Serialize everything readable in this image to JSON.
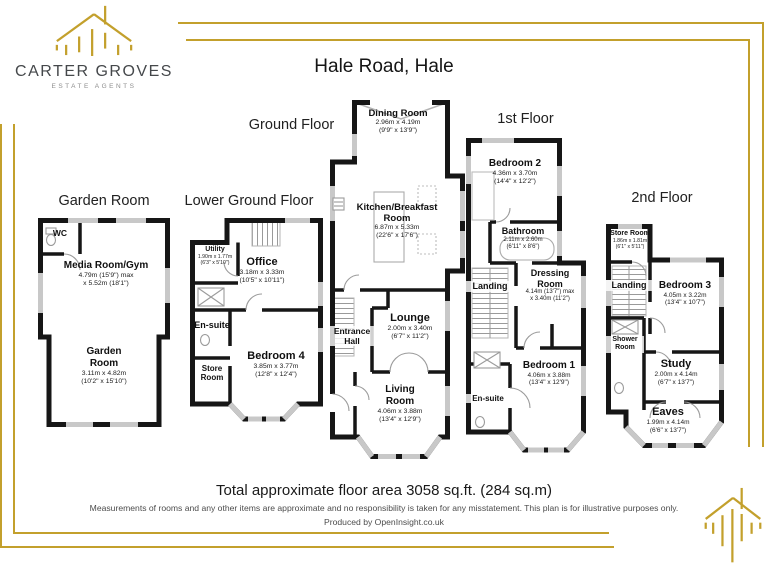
{
  "brand": {
    "name": "CARTER GROVES",
    "tagline": "ESTATE AGENTS"
  },
  "title": "Hale Road, Hale",
  "colors": {
    "gold": "#c3a02c",
    "wall": "#161616"
  },
  "floors": {
    "garden": {
      "label": "Garden Room",
      "rooms": {
        "wc": {
          "name": "WC"
        },
        "media": {
          "name": "Media Room/Gym",
          "line1": "4.79m (15'9\") max",
          "line2": "x 5.52m (18'1\")"
        },
        "garden": {
          "name": "Garden Room",
          "line1": "3.11m x 4.82m",
          "line2": "(10'2\" x 15'10\")"
        }
      }
    },
    "lower": {
      "label": "Lower Ground Floor",
      "rooms": {
        "utility": {
          "name": "Utility",
          "line1": "1.90m x 1.77m",
          "line2": "(6'3\" x 5'10\")"
        },
        "office": {
          "name": "Office",
          "line1": "3.18m x 3.33m",
          "line2": "(10'5\" x 10'11\")"
        },
        "ensuite": {
          "name": "En-suite"
        },
        "bedroom4": {
          "name": "Bedroom 4",
          "line1": "3.85m x 3.77m",
          "line2": "(12'8\" x 12'4\")"
        },
        "store": {
          "name": "Store Room"
        }
      }
    },
    "ground": {
      "label": "Ground Floor",
      "rooms": {
        "dining": {
          "name": "Dining Room",
          "line1": "2.96m x 4.19m",
          "line2": "(9'9\" x 13'9\")"
        },
        "kitchen": {
          "name": "Kitchen/Breakfast Room",
          "line1": "6.87m x 5.33m",
          "line2": "(22'6\" x 17'6\")"
        },
        "lounge": {
          "name": "Lounge",
          "line1": "2.00m x 3.40m",
          "line2": "(6'7\" x 11'2\")"
        },
        "hall": {
          "name": "Entrance Hall"
        },
        "living": {
          "name": "Living Room",
          "line1": "4.06m x 3.88m",
          "line2": "(13'4\" x 12'9\")"
        }
      }
    },
    "first": {
      "label": "1st Floor",
      "rooms": {
        "bedroom2": {
          "name": "Bedroom 2",
          "line1": "4.36m x 3.70m",
          "line2": "(14'4\" x 12'2\")"
        },
        "bathroom": {
          "name": "Bathroom",
          "line1": "2.11m x 2.60m",
          "line2": "(6'11\" x 8'6\")"
        },
        "landing": {
          "name": "Landing"
        },
        "dressing": {
          "name": "Dressing Room",
          "line1": "4.14m (13'7\") max",
          "line2": "x 3.40m (11'2\")"
        },
        "ensuite": {
          "name": "En-suite"
        },
        "bedroom1": {
          "name": "Bedroom 1",
          "line1": "4.06m x 3.88m",
          "line2": "(13'4\" x 12'9\")"
        }
      }
    },
    "second": {
      "label": "2nd Floor",
      "rooms": {
        "store": {
          "name": "Store Room",
          "line1": "1.86m x 1.81m",
          "line2": "(6'1\" x 5'11\")"
        },
        "landing": {
          "name": "Landing"
        },
        "bedroom3": {
          "name": "Bedroom 3",
          "line1": "4.05m x 3.22m",
          "line2": "(13'4\" x 10'7\")"
        },
        "shower": {
          "name": "Shower Room"
        },
        "study": {
          "name": "Study",
          "line1": "2.00m x 4.14m",
          "line2": "(6'7\" x 13'7\")"
        },
        "eaves": {
          "name": "Eaves",
          "line1": "1.99m x 4.14m",
          "line2": "(6'6\" x 13'7\")"
        }
      }
    }
  },
  "footer": {
    "total": "Total approximate floor area 3058 sq.ft. (284 sq.m)",
    "disclaimer": "Measurements of rooms and any other items are approximate and no responsibility is taken for any misstatement. This plan is for illustrative purposes only.",
    "produced": "Produced by OpenInsight.co.uk"
  }
}
